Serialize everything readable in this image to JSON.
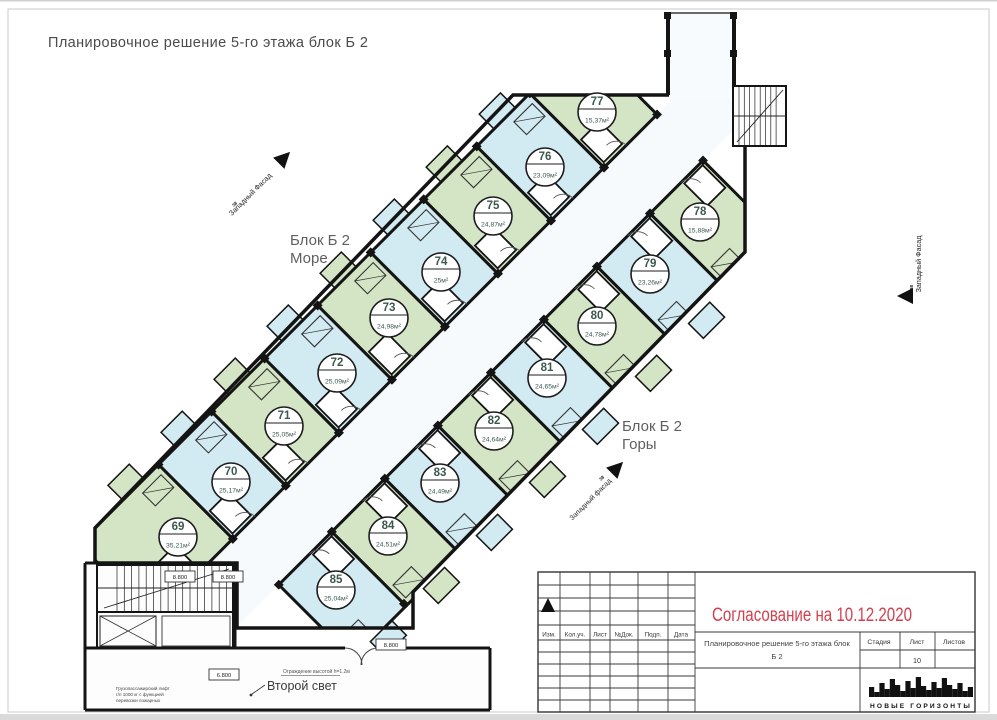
{
  "sheet": {
    "title": "Планировочное решение 5-го этажа блок Б 2"
  },
  "plan": {
    "labels": {
      "sea": {
        "line1": "Блок Б 2",
        "line2": "Море"
      },
      "mountain": {
        "line1": "Блок Б 2",
        "line2": "Горы"
      }
    },
    "facade": {
      "text": "Западный Фасад",
      "text_lower": "Западный фасад",
      "axis": "38"
    },
    "annotations": {
      "second_light": "Второй свет",
      "railing": "Ограждение высотой h=1.2м",
      "lift_lines": [
        "Грузопассажирский лифт",
        "г/п 1000 кг с функцией",
        "перевозки пожарных"
      ],
      "elevations": [
        {
          "x": 165,
          "y": 571,
          "v": "8.800"
        },
        {
          "x": 213,
          "y": 571,
          "v": "8.800"
        },
        {
          "x": 376,
          "y": 639,
          "v": "8.800"
        },
        {
          "x": 209,
          "y": 669,
          "v": "6.800"
        }
      ]
    },
    "apartments": [
      {
        "num": "69",
        "area": "35,21м²",
        "color": "green",
        "row": "sea",
        "u": 0,
        "wide": true,
        "cx": 178,
        "cy": 537
      },
      {
        "num": "70",
        "area": "25,17м²",
        "color": "blue",
        "row": "sea",
        "u": 75,
        "cx": 231,
        "cy": 482
      },
      {
        "num": "71",
        "area": "25,05м²",
        "color": "green",
        "row": "sea",
        "u": 150,
        "cx": 284,
        "cy": 426
      },
      {
        "num": "72",
        "area": "25,09м²",
        "color": "blue",
        "row": "sea",
        "u": 225,
        "cx": 337,
        "cy": 373
      },
      {
        "num": "73",
        "area": "24,98м²",
        "color": "green",
        "row": "sea",
        "u": 300,
        "cx": 389,
        "cy": 318
      },
      {
        "num": "74",
        "area": "25м²",
        "color": "blue",
        "row": "sea",
        "u": 375,
        "cx": 441,
        "cy": 272
      },
      {
        "num": "75",
        "area": "24,87м²",
        "color": "green",
        "row": "sea",
        "u": 450,
        "cx": 493,
        "cy": 216
      },
      {
        "num": "76",
        "area": "23,09м²",
        "color": "blue",
        "row": "sea",
        "u": 525,
        "cx": 545,
        "cy": 167
      },
      {
        "num": "77",
        "area": "15,37м²",
        "color": "green",
        "row": "sea",
        "u": 600,
        "cx": 597,
        "cy": 112
      },
      {
        "num": "78",
        "area": "15,88м²",
        "color": "green",
        "row": "mtn",
        "u": 600,
        "cx": 700,
        "cy": 222
      },
      {
        "num": "79",
        "area": "23,26м²",
        "color": "blue",
        "row": "mtn",
        "u": 525,
        "cx": 650,
        "cy": 274
      },
      {
        "num": "80",
        "area": "24,78м²",
        "color": "green",
        "row": "mtn",
        "u": 450,
        "cx": 597,
        "cy": 326
      },
      {
        "num": "81",
        "area": "24,65м²",
        "color": "blue",
        "row": "mtn",
        "u": 375,
        "cx": 547,
        "cy": 378
      },
      {
        "num": "82",
        "area": "24,64м²",
        "color": "green",
        "row": "mtn",
        "u": 300,
        "cx": 494,
        "cy": 431
      },
      {
        "num": "83",
        "area": "24,49м²",
        "color": "blue",
        "row": "mtn",
        "u": 225,
        "cx": 440,
        "cy": 483
      },
      {
        "num": "84",
        "area": "24,51м²",
        "color": "green",
        "row": "mtn",
        "u": 150,
        "cx": 388,
        "cy": 536
      },
      {
        "num": "85",
        "area": "25,04м²",
        "color": "blue",
        "row": "mtn",
        "u": 75,
        "cx": 336,
        "cy": 590
      }
    ],
    "colors": {
      "green": "#d3e5c5",
      "blue": "#d2eaf1",
      "wall": "#141414",
      "corridor": "#f6fafc",
      "circle_text": "#3c584d"
    }
  },
  "title_block": {
    "approval": "Согласование на 10.12.2020",
    "accent_red": "#d2404e",
    "columns": [
      "Изм.",
      "Кол.уч.",
      "Лист",
      "№Док.",
      "Подп.",
      "Дата"
    ],
    "doc_title_line1": "Планировочное решение 5-го этажа блок",
    "doc_title_line2": "Б 2",
    "stage_label": "Стадия",
    "sheet_label": "Лист",
    "sheets_label": "Листов",
    "sheet_number": "10",
    "logo": "НОВЫЕ ГОРИЗОНТЫ"
  }
}
